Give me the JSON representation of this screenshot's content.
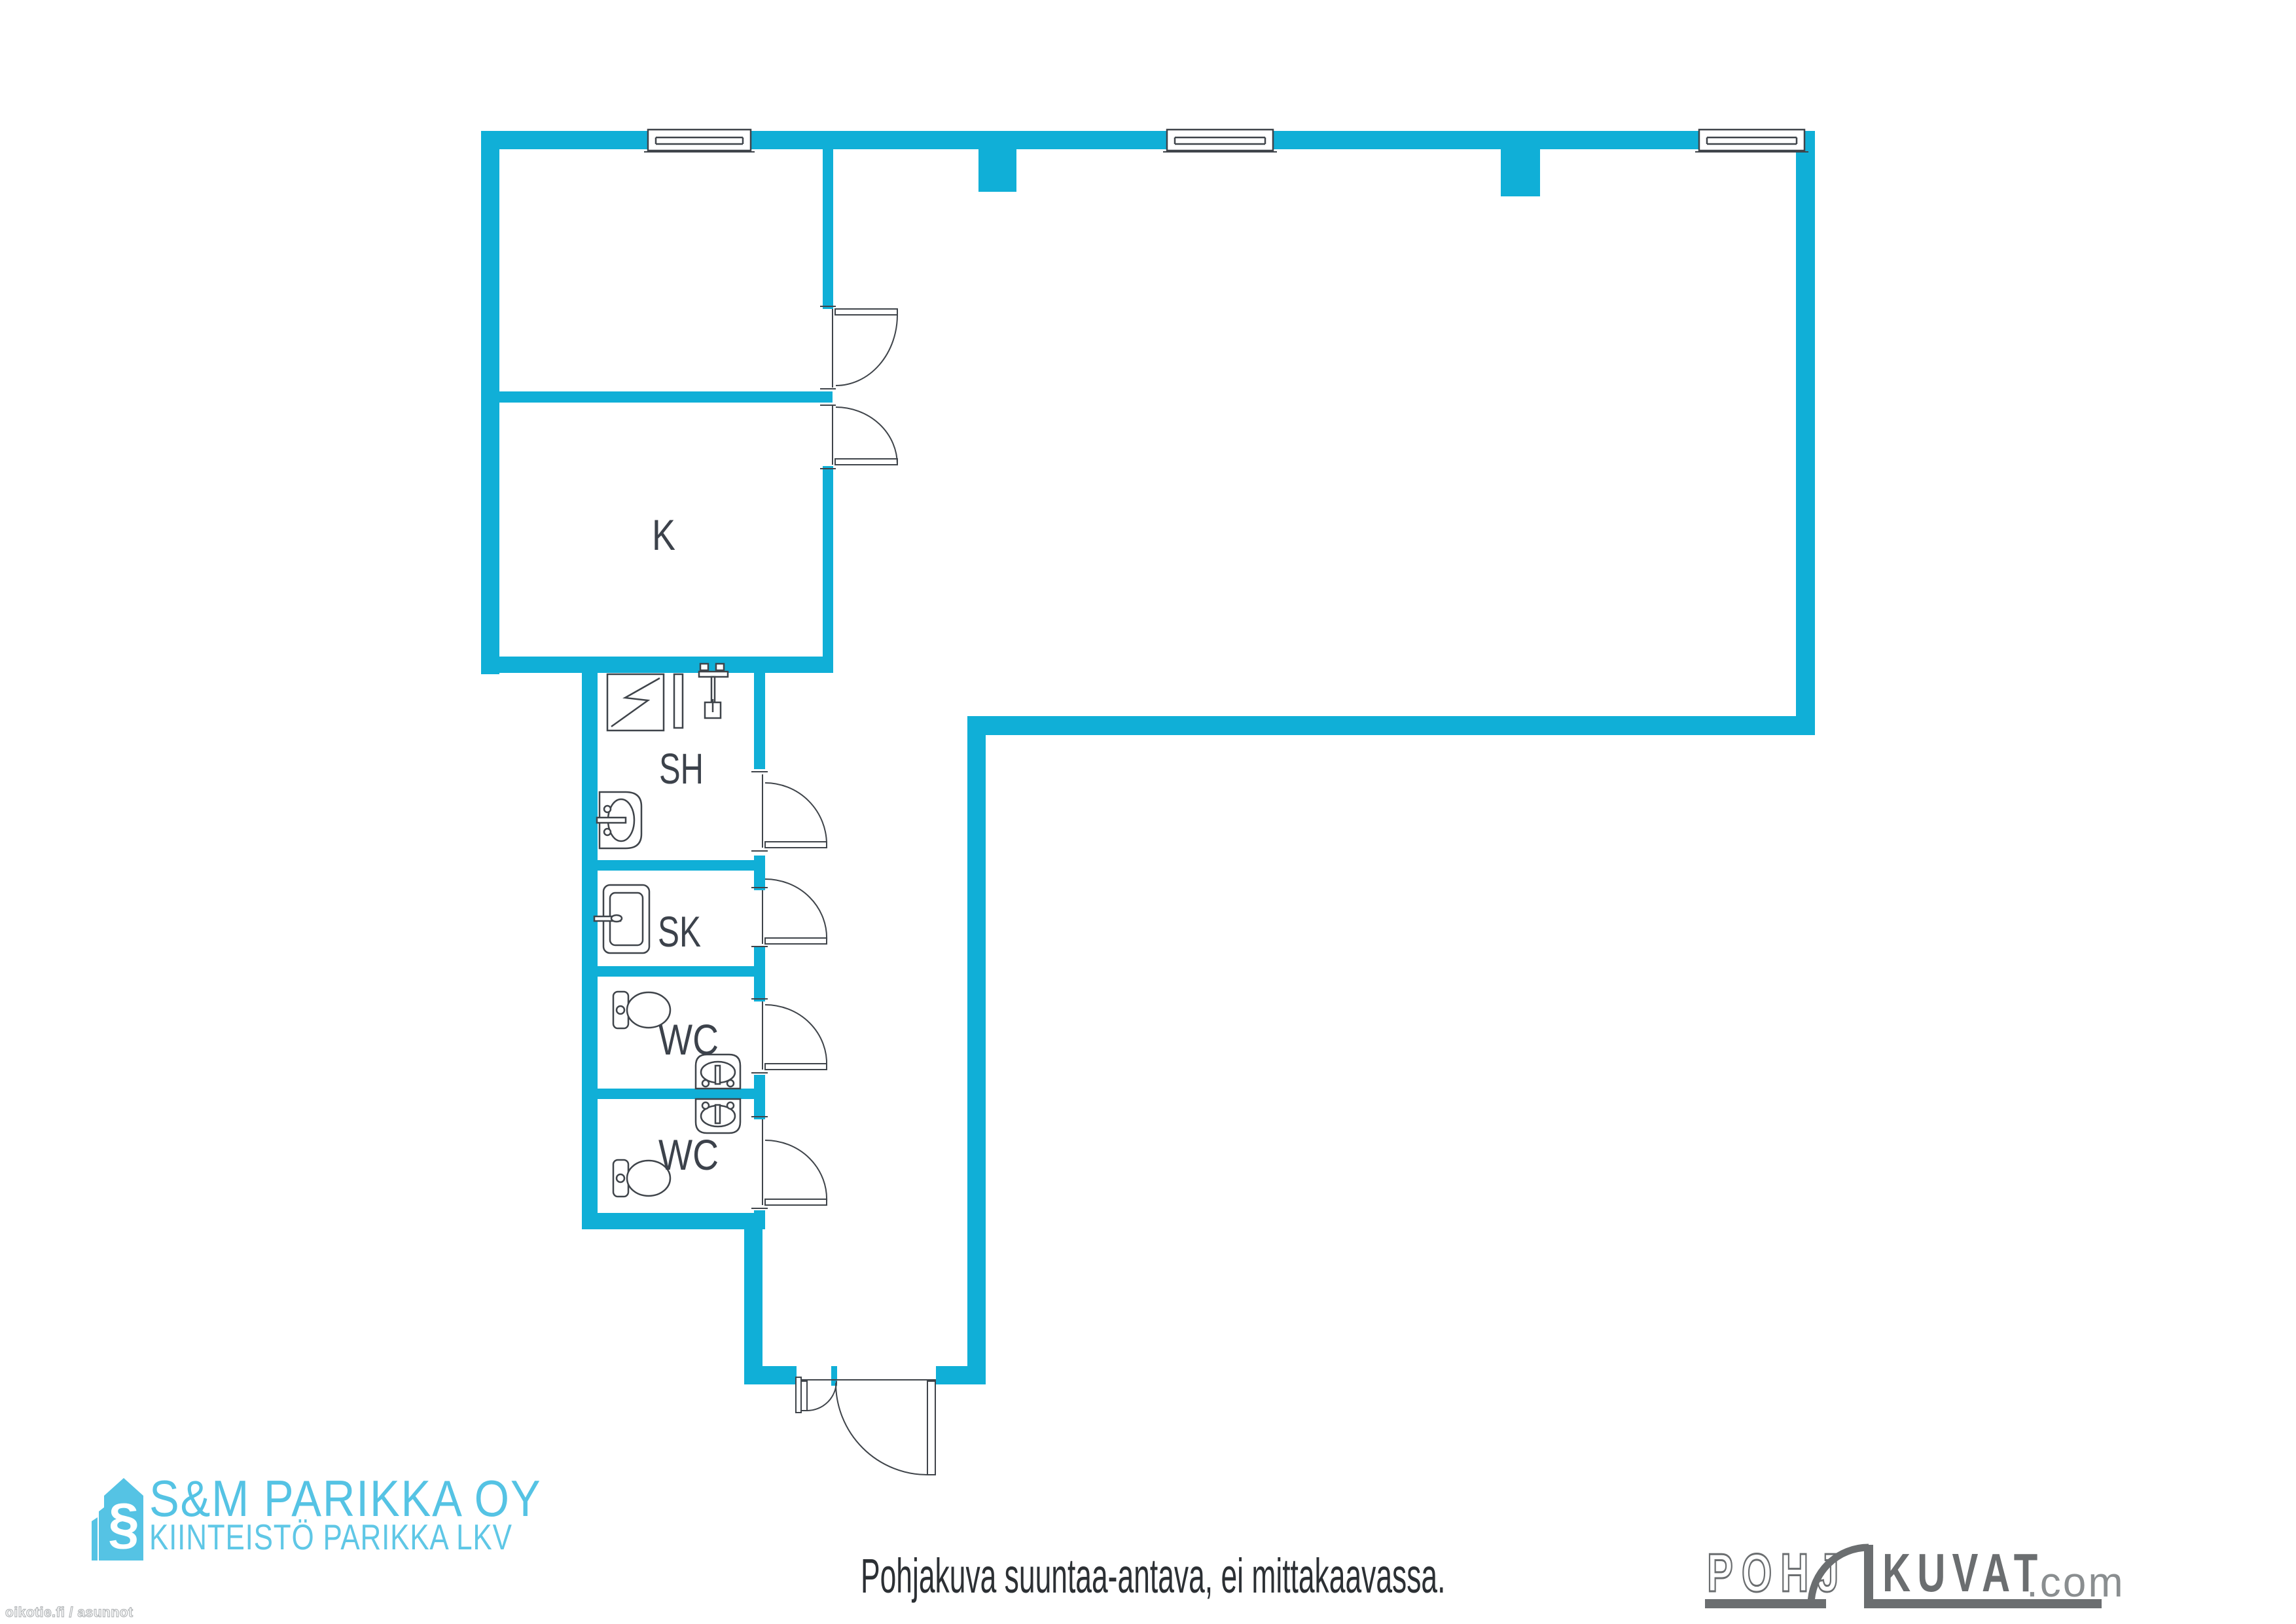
{
  "page": {
    "title": "Pohjakuva",
    "background": "#ffffff"
  },
  "colors": {
    "wall": "#10afd7",
    "line": "#3f444a",
    "label": "#3c424b",
    "agency_cyan": "#55c3e4",
    "portal_gray": "#6b6e70",
    "portal_gray_light": "#8a8e90"
  },
  "plan": {
    "rooms": {
      "k": {
        "label": "K"
      },
      "sh": {
        "label": "SH"
      },
      "sk": {
        "label": "SK"
      },
      "wc1": {
        "label": "WC"
      },
      "wc2": {
        "label": "WC"
      }
    },
    "window_count": 3,
    "door_count": 7,
    "fixture_icons": [
      "shower-drain-icon",
      "shower-screen-icon",
      "shower-mixer-icon",
      "washbasin-icon",
      "cleaning-cabinet-icon",
      "toilet-icon",
      "washbasin-icon",
      "washbasin-icon",
      "toilet-icon"
    ]
  },
  "footer": {
    "disclaimer": "Pohjakuva suuntaa-antava, ei mittakaavassa."
  },
  "branding": {
    "agency": {
      "line1": "S&M PARIKKA OY",
      "line2": "KIINTEISTÖ PARIKKA LKV",
      "icon_glyph": "§"
    },
    "portal": {
      "part1": "POHJ",
      "part2": "KUVAT",
      "suffix": ".com"
    },
    "watermark": "oikotie.fi / asunnot"
  }
}
